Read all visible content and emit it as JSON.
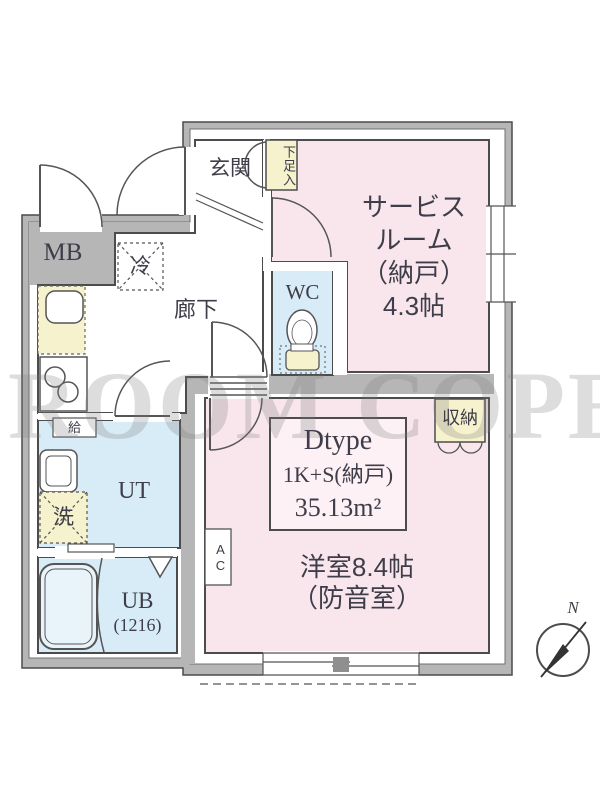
{
  "plan": {
    "entrance_label": "玄関",
    "shoe_box_label": "下足入",
    "service_room_lines": [
      "サービス",
      "ルーム",
      "（納戸）",
      "4.3帖"
    ],
    "meter_box_label": "MB",
    "refrigerator_label": "冷",
    "hallway_label": "廊下",
    "wc_label": "WC",
    "hot_water_label": "給",
    "utility_label": "UT",
    "washer_label": "洗",
    "bath_lines": [
      "UB",
      "(1216)"
    ],
    "closet_label": "収納",
    "ac_label": "AC",
    "main_room_lines": [
      "洋室8.4帖",
      "（防音室）"
    ]
  },
  "info_box": {
    "lines": [
      "Dtype",
      "1K+S(納戸)",
      "35.13m²"
    ]
  },
  "compass": {
    "north_label": "N"
  },
  "watermark": "ROOM COPE",
  "colors": {
    "wall_gray": "#b6b6b6",
    "room_pink": "#f9e6ed",
    "room_blue": "#d8ecf7",
    "fixture_yellow": "#f6f2cd",
    "outline": "#4c4c4c",
    "text": "#3e3d49"
  }
}
